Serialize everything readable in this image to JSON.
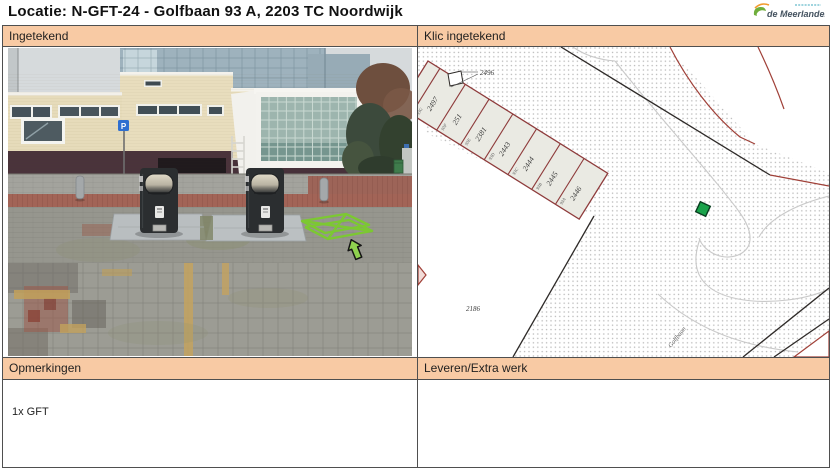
{
  "title": "Locatie: N-GFT-24 - Golfbaan 93 A, 2203 TC Noordwijk",
  "logo": {
    "text": "de Meerlanden"
  },
  "panels": {
    "ingetekend": {
      "label": "Ingetekend"
    },
    "klic_ingetekend": {
      "label": "Klic ingetekend"
    },
    "opmerkingen": {
      "label": "Opmerkingen",
      "content": "1x GFT"
    },
    "leveren_extra_werk": {
      "label": "Leveren/Extra werk",
      "content": ""
    }
  },
  "map": {
    "area_labels": {
      "top": "2496",
      "bottom": "2186"
    },
    "street": "Golfbaan",
    "parcels": [
      {
        "number": "",
        "house": "93H"
      },
      {
        "number": "2497",
        "house": "93G"
      },
      {
        "number": "251",
        "house": "93F"
      },
      {
        "number": "2381",
        "house": "93E"
      },
      {
        "number": "2443",
        "house": "93D"
      },
      {
        "number": "2444",
        "house": "93C"
      },
      {
        "number": "2445",
        "house": "93B"
      },
      {
        "number": "2446",
        "house": "93A"
      }
    ],
    "marker_color": "#19A24A"
  },
  "photo": {
    "sign": "P",
    "marker_color": "#7CC832"
  },
  "colors": {
    "header_bg": "#F8CAA4",
    "border": "#4F4F4F",
    "parcel_outline": "#8E3B3B"
  }
}
